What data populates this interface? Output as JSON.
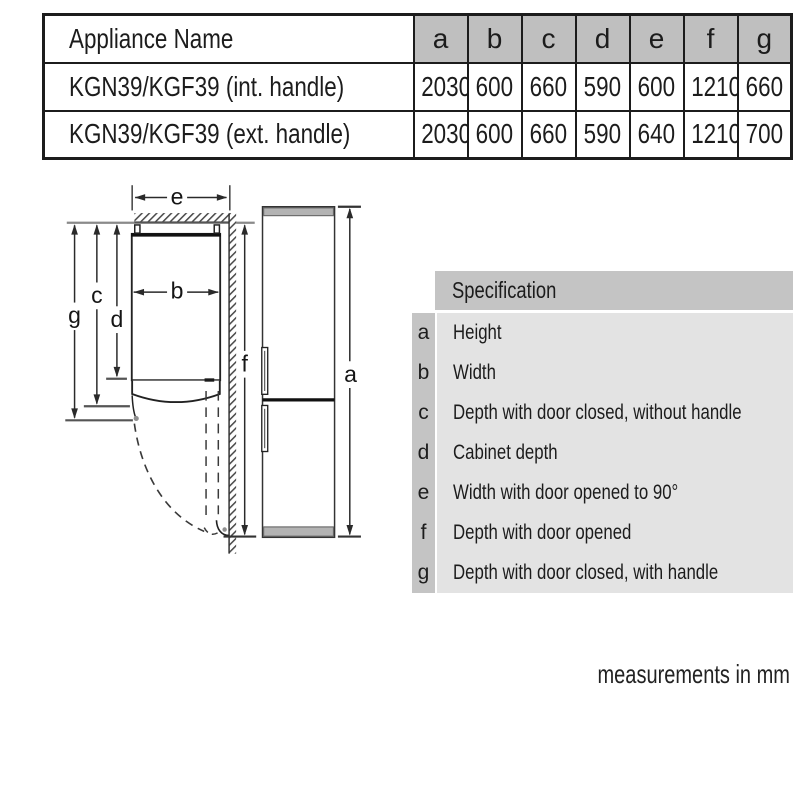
{
  "dimension_table": {
    "name_header": "Appliance Name",
    "column_headers": [
      "a",
      "b",
      "c",
      "d",
      "e",
      "f",
      "g"
    ],
    "rows": [
      {
        "name": "KGN39/KGF39 (int. handle)",
        "values": [
          "2030",
          "600",
          "660",
          "590",
          "600",
          "1210",
          "660"
        ]
      },
      {
        "name": "KGN39/KGF39 (ext. handle)",
        "values": [
          "2030",
          "600",
          "660",
          "590",
          "640",
          "1210",
          "700"
        ]
      }
    ]
  },
  "spec_legend": {
    "header": "Specification",
    "items": [
      {
        "key": "a",
        "label": "Height"
      },
      {
        "key": "b",
        "label": "Width"
      },
      {
        "key": "c",
        "label": "Depth with door closed, without handle"
      },
      {
        "key": "d",
        "label": "Cabinet depth"
      },
      {
        "key": "e",
        "label": "Width with door opened to 90°"
      },
      {
        "key": "f",
        "label": "Depth with door opened"
      },
      {
        "key": "g",
        "label": "Depth with door closed, with handle"
      }
    ]
  },
  "diagram": {
    "dimension_labels": {
      "a": "a",
      "b": "b",
      "c": "c",
      "d": "d",
      "e": "e",
      "f": "f",
      "g": "g"
    }
  },
  "footer": {
    "note": "measurements in mm"
  },
  "colors": {
    "table_header_fill": "#bfbfbf",
    "legend_header_fill": "#c4c4c4",
    "legend_body_fill": "#e3e3e3",
    "appliance_gray": "#b3b3b3",
    "line_dark": "#1c1c1c",
    "wall_gray": "#8a8a8a"
  }
}
